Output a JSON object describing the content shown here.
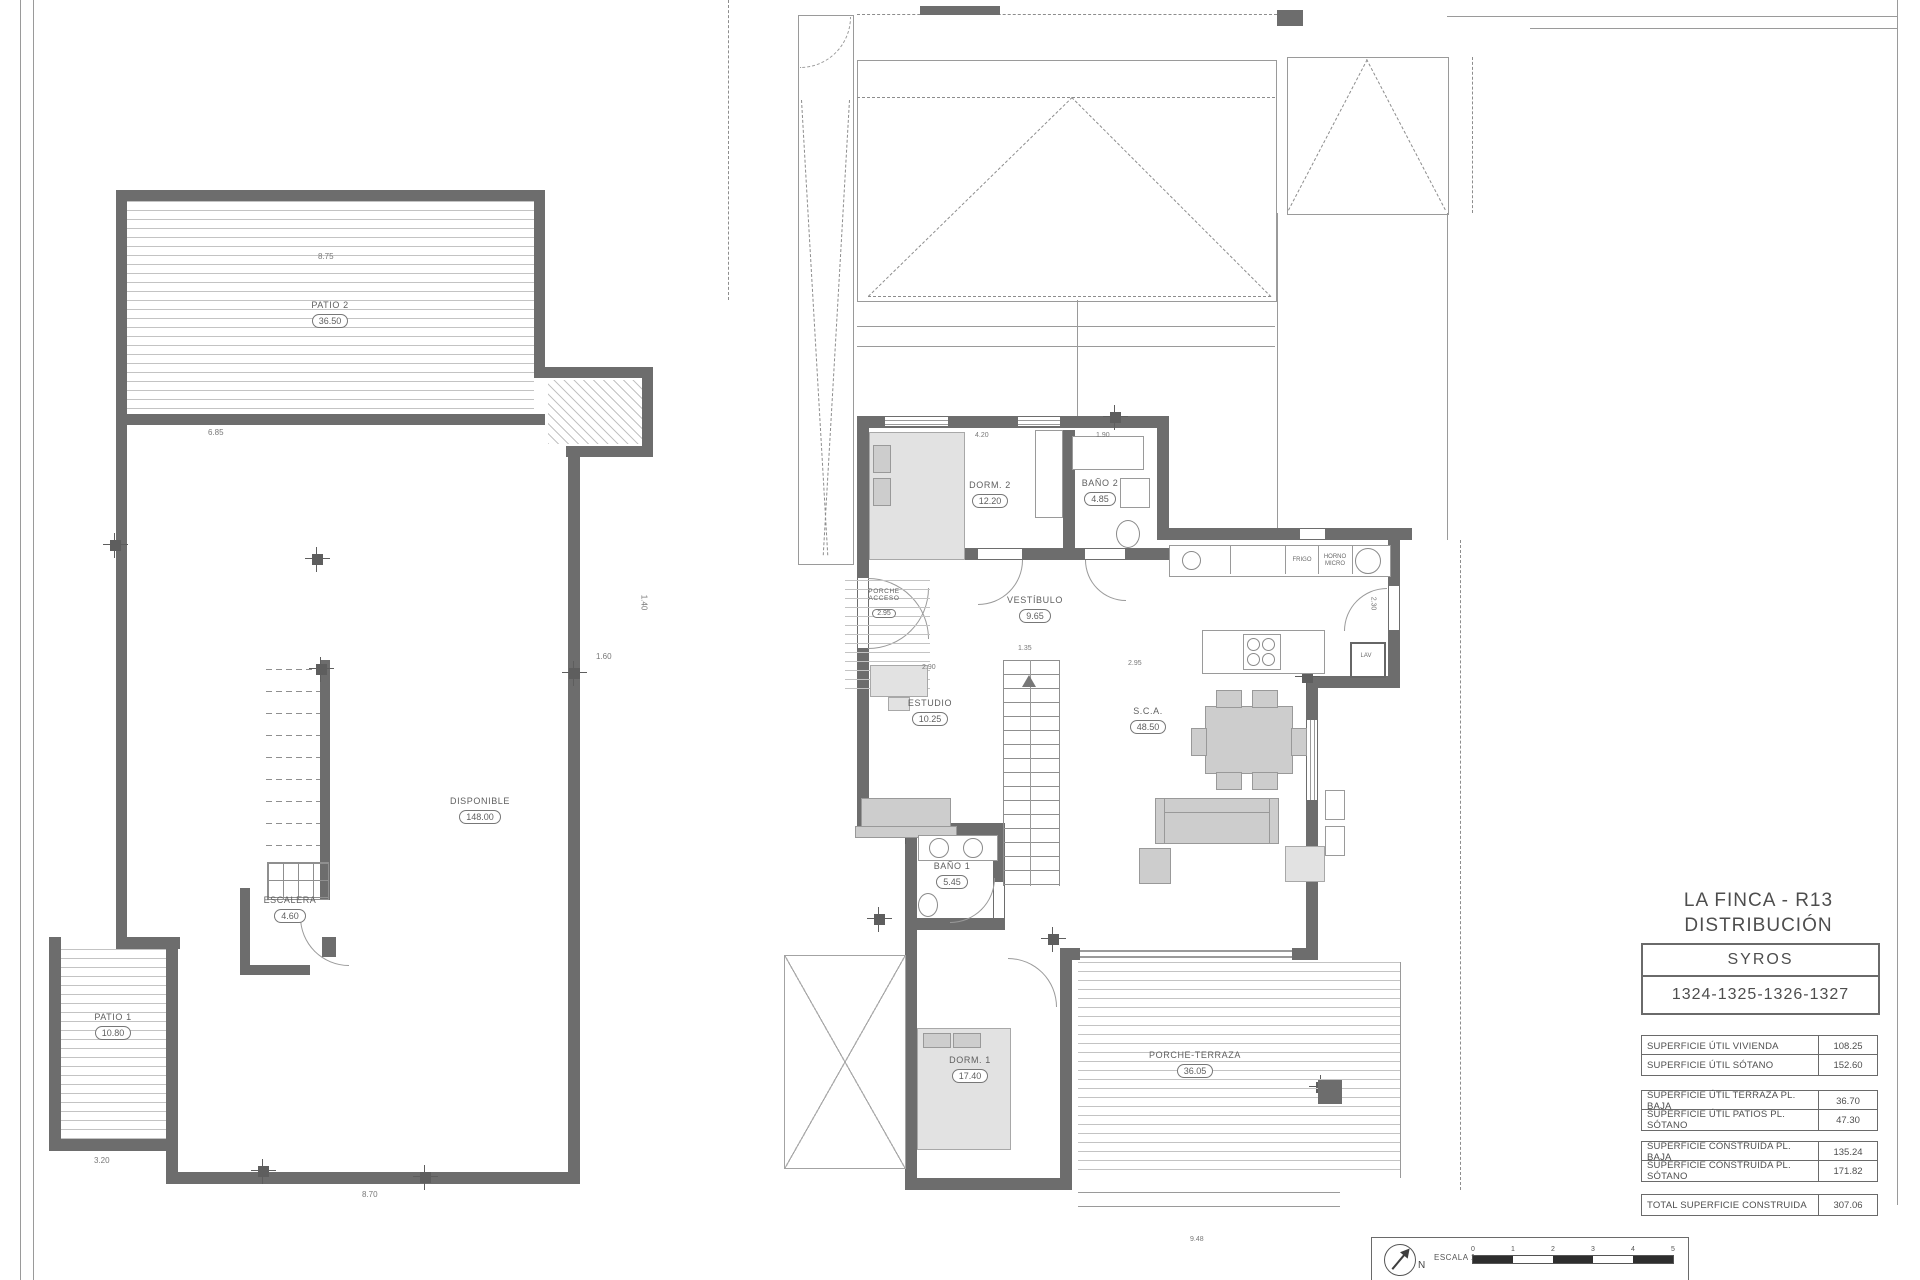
{
  "titleblock": {
    "project": "LA FINCA - R13",
    "drawing": "DISTRIBUCIÓN",
    "model": "SYROS",
    "plots": "1324-1325-1326-1327",
    "rows": [
      {
        "label": "SUPERFICIE ÚTIL VIVIENDA",
        "value": "108.25"
      },
      {
        "label": "SUPERFICIE ÚTIL SÓTANO",
        "value": "152.60"
      },
      {
        "label": "SUPERFICIE ÚTIL TERRAZA PL. BAJA",
        "value": "36.70"
      },
      {
        "label": "SUPERFICIE ÚTIL PATIOS PL. SÓTANO",
        "value": "47.30"
      },
      {
        "label": "SUPERFICIE CONSTRUIDA PL. BAJA",
        "value": "135.24"
      },
      {
        "label": "SUPERFICIE CONSTRUIDA PL. SÓTANO",
        "value": "171.82"
      }
    ],
    "total": {
      "label": "TOTAL SUPERFICIE CONSTRUIDA",
      "value": "307.06"
    }
  },
  "basement": {
    "rooms": {
      "patio2": {
        "name": "PATIO 2",
        "area": "36.50"
      },
      "disponible": {
        "name": "DISPONIBLE",
        "area": "148.00"
      },
      "escalera": {
        "name": "ESCALERA",
        "area": "4.60"
      },
      "patio1": {
        "name": "PATIO 1",
        "area": "10.80"
      }
    },
    "dims": {
      "top": "8.75",
      "inner": "6.85",
      "step": "1.60",
      "right_v": "1.40",
      "bottom": "8.70",
      "patio1_w": "3.20"
    }
  },
  "ground": {
    "rooms": {
      "dorm2": {
        "name": "DORM. 2",
        "area": "12.20"
      },
      "bano2": {
        "name": "BAÑO 2",
        "area": "4.85"
      },
      "vestibulo": {
        "name": "VESTÍBULO",
        "area": "9.65"
      },
      "porche_acceso": {
        "name1": "PORCHE",
        "name2": "ACCESO",
        "area": "2.95"
      },
      "estudio": {
        "name": "ESTUDIO",
        "area": "10.25"
      },
      "sca": {
        "name": "S.C.A.",
        "area": "48.50"
      },
      "bano1": {
        "name": "BAÑO 1",
        "area": "5.45"
      },
      "dorm1": {
        "name": "DORM. 1",
        "area": "17.40"
      },
      "terraza": {
        "name": "PORCHE-TERRAZA",
        "area": "36.05"
      }
    },
    "kitchen": {
      "frigo": "FRIGO",
      "horno": "HORNO MICRO",
      "lav": "LAV"
    },
    "dims": {
      "top1": "4.20",
      "top2": "1.90",
      "entry": "2.90",
      "stair": "1.35",
      "hall": "2.95",
      "kitchen_v": "2.30",
      "bottom": "9.48"
    }
  },
  "legend": {
    "north": "N",
    "scale_label": "ESCALA 1:",
    "ticks": [
      "0",
      "1",
      "2",
      "3",
      "4",
      "5"
    ]
  }
}
